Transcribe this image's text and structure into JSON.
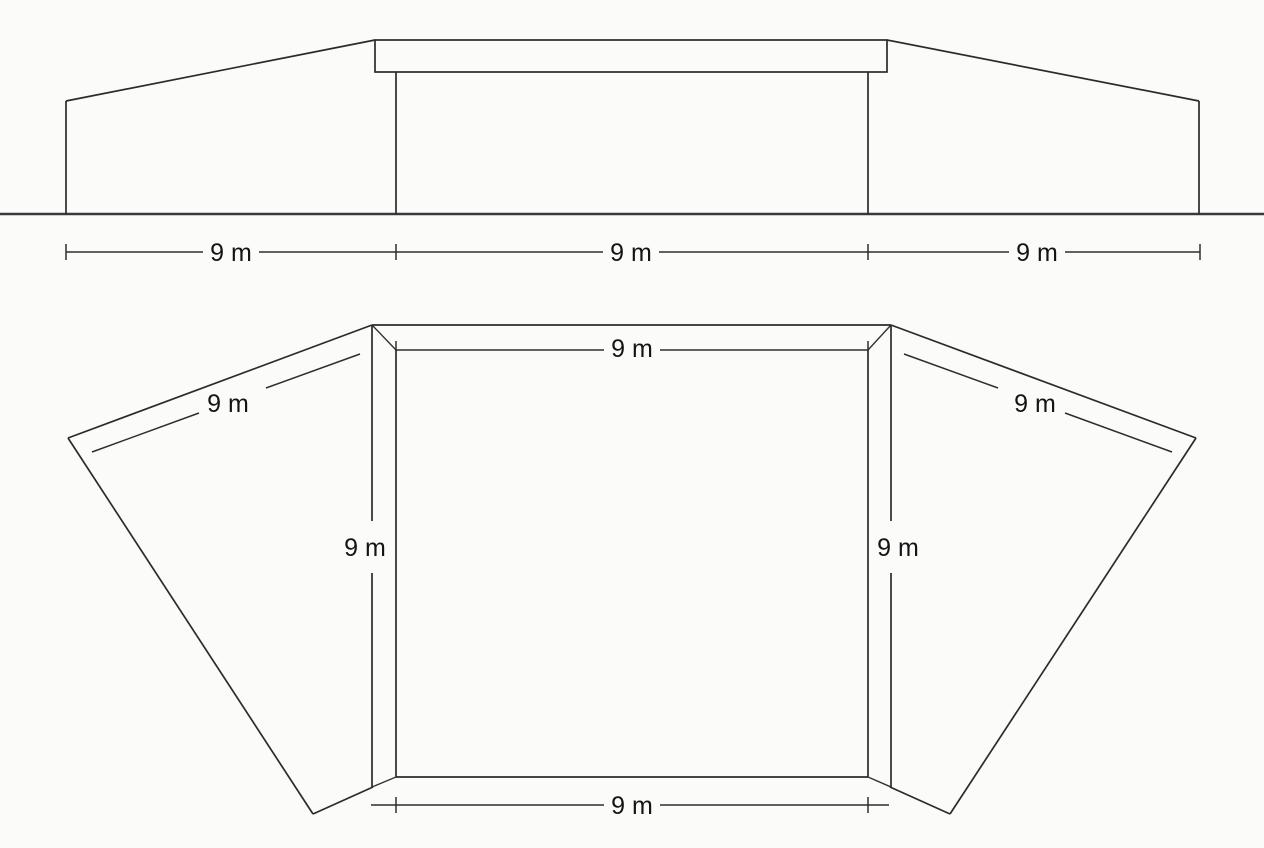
{
  "figure": {
    "kind": "architectural-drawing",
    "unit": "m",
    "dimension_value": 9,
    "line_color": "#2b2b2b",
    "background_color": "#fbfbfa",
    "text_color": "#141414"
  },
  "elevation": {
    "name": "front-elevation-view",
    "dim_labels": [
      "9 m",
      "9 m",
      "9 m"
    ]
  },
  "plan": {
    "name": "plan-view",
    "square_labels": {
      "top": "9 m",
      "left": "9 m",
      "right": "9 m",
      "bottom": "9 m"
    },
    "wing_labels": {
      "left": "9 m",
      "right": "9 m"
    }
  }
}
